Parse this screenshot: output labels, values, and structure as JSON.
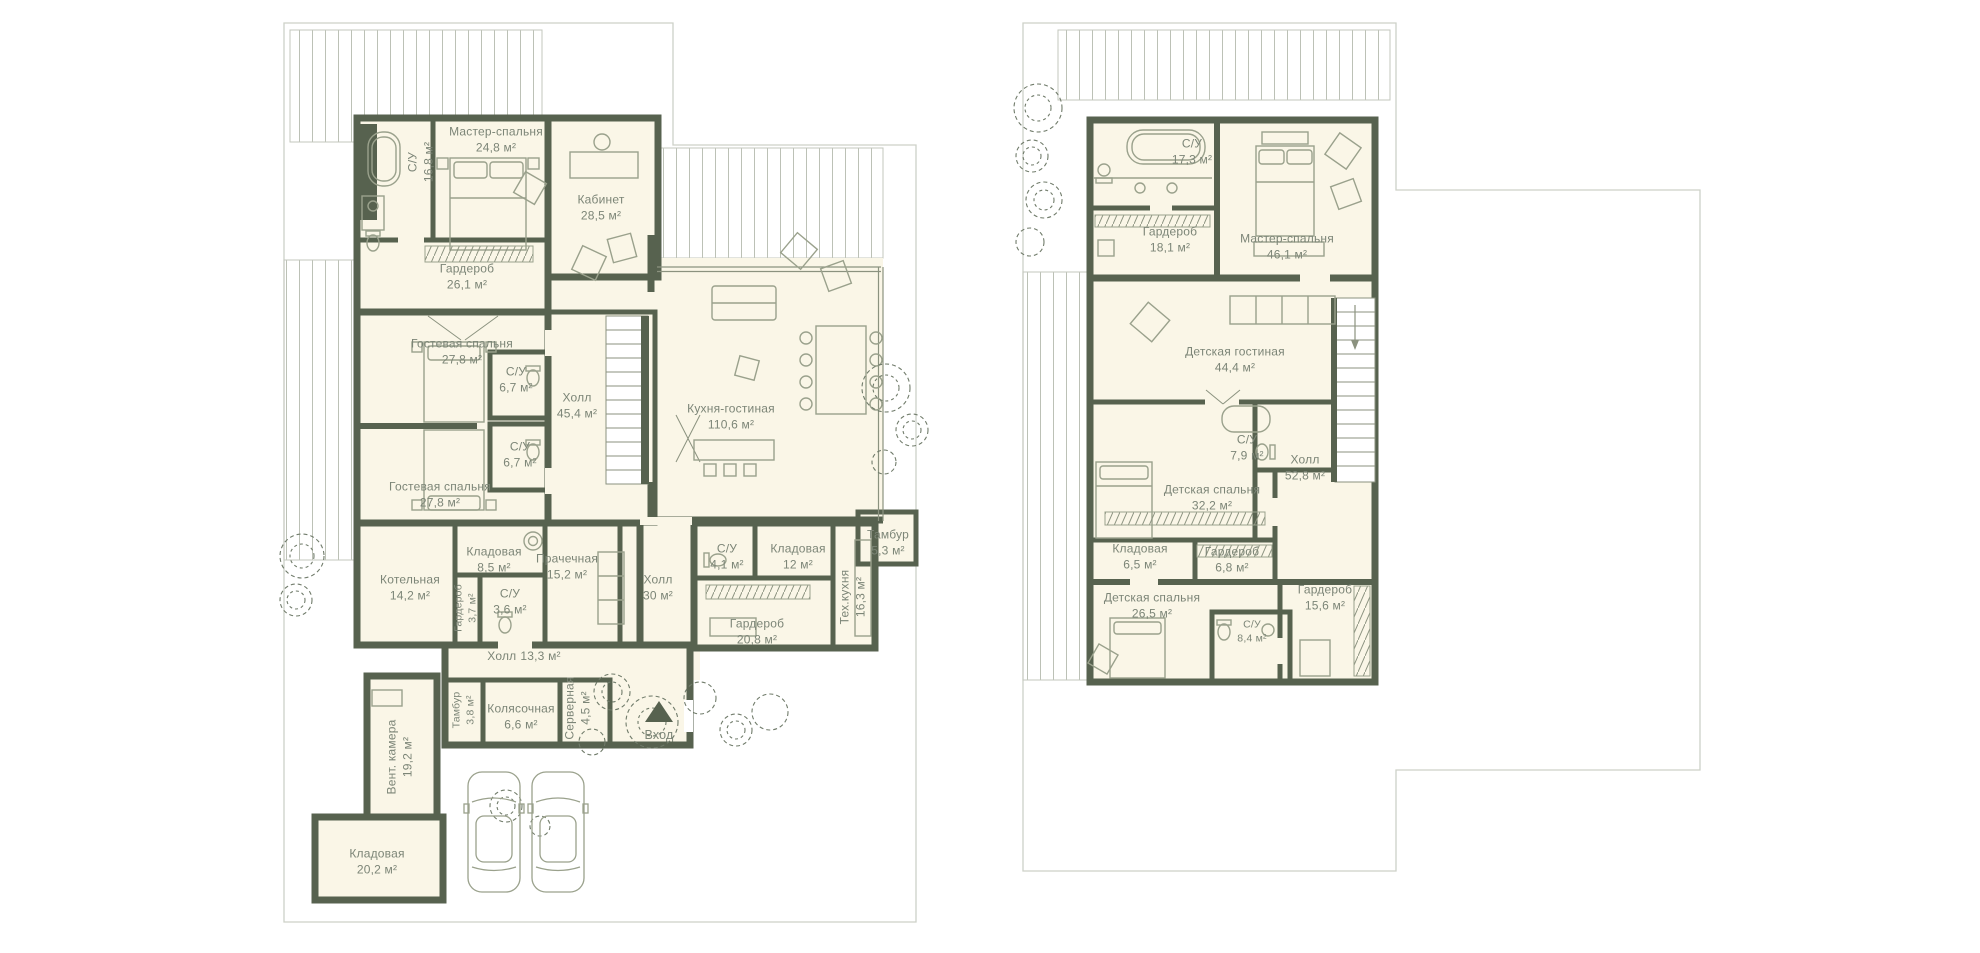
{
  "palette": {
    "wall": "#57624f",
    "floor": "#faf6e7",
    "text": "#7c8577",
    "furniture": "#9aa18c",
    "deck_line": "#bcc1b6",
    "lot_outline": "#cdd1c8"
  },
  "entrance": {
    "label": "Вход"
  },
  "floor1": {
    "rooms": [
      {
        "name": "С/У",
        "area": "16,8 м²"
      },
      {
        "name": "Мастер-спальня",
        "area": "24,8 м²"
      },
      {
        "name": "Кабинет",
        "area": "28,5 м²"
      },
      {
        "name": "Гардероб",
        "area": "26,1 м²"
      },
      {
        "name": "Гостевая спальня",
        "area": "27,8 м²"
      },
      {
        "name": "С/У",
        "area": "6,7 м²"
      },
      {
        "name": "Холл",
        "area": "45,4 м²"
      },
      {
        "name": "Кухня-гостиная",
        "area": "110,6 м²"
      },
      {
        "name": "С/У",
        "area": "6,7 м²"
      },
      {
        "name": "Гостевая спальня",
        "area": "27,8 м²"
      },
      {
        "name": "Котельная",
        "area": "14,2 м²"
      },
      {
        "name": "Кладовая",
        "area": "8,5 м²"
      },
      {
        "name": "Прачечная",
        "area": "15,2 м²"
      },
      {
        "name": "Гардероб",
        "area": "3,7 м²"
      },
      {
        "name": "С/У",
        "area": "3,6 м²"
      },
      {
        "name": "Холл",
        "area": "30 м²"
      },
      {
        "name": "С/У",
        "area": "4,1 м²"
      },
      {
        "name": "Кладовая",
        "area": "12 м²"
      },
      {
        "name": "Тамбур",
        "area": "5,3 м²"
      },
      {
        "name": "Тех.кухня",
        "area": "16,3 м²"
      },
      {
        "name": "Гардероб",
        "area": "20,8 м²"
      },
      {
        "name": "Холл",
        "area": "13,3 м²"
      },
      {
        "name": "Тамбур",
        "area": "3,8 м²"
      },
      {
        "name": "Колясочная",
        "area": "6,6 м²"
      },
      {
        "name": "Серверная",
        "area": "4,5 м²"
      },
      {
        "name": "Вент. камера",
        "area": "19,2 м²"
      },
      {
        "name": "Кладовая",
        "area": "20,2 м²"
      }
    ]
  },
  "floor2": {
    "rooms": [
      {
        "name": "С/У",
        "area": "17,3 м²"
      },
      {
        "name": "Гардероб",
        "area": "18,1 м²"
      },
      {
        "name": "Мастер-спальня",
        "area": "46,1 м²"
      },
      {
        "name": "Детская гостиная",
        "area": "44,4 м²"
      },
      {
        "name": "С/У",
        "area": "7,9 м²"
      },
      {
        "name": "Холл",
        "area": "52,8 м²"
      },
      {
        "name": "Детская спальня",
        "area": "32,2 м²"
      },
      {
        "name": "Кладовая",
        "area": "6,5 м²"
      },
      {
        "name": "Гардероб",
        "area": "6,8 м²"
      },
      {
        "name": "Гардероб",
        "area": "15,6 м²"
      },
      {
        "name": "Детская спальня",
        "area": "26,5 м²"
      },
      {
        "name": "С/У",
        "area": "8,4 м²"
      }
    ]
  }
}
